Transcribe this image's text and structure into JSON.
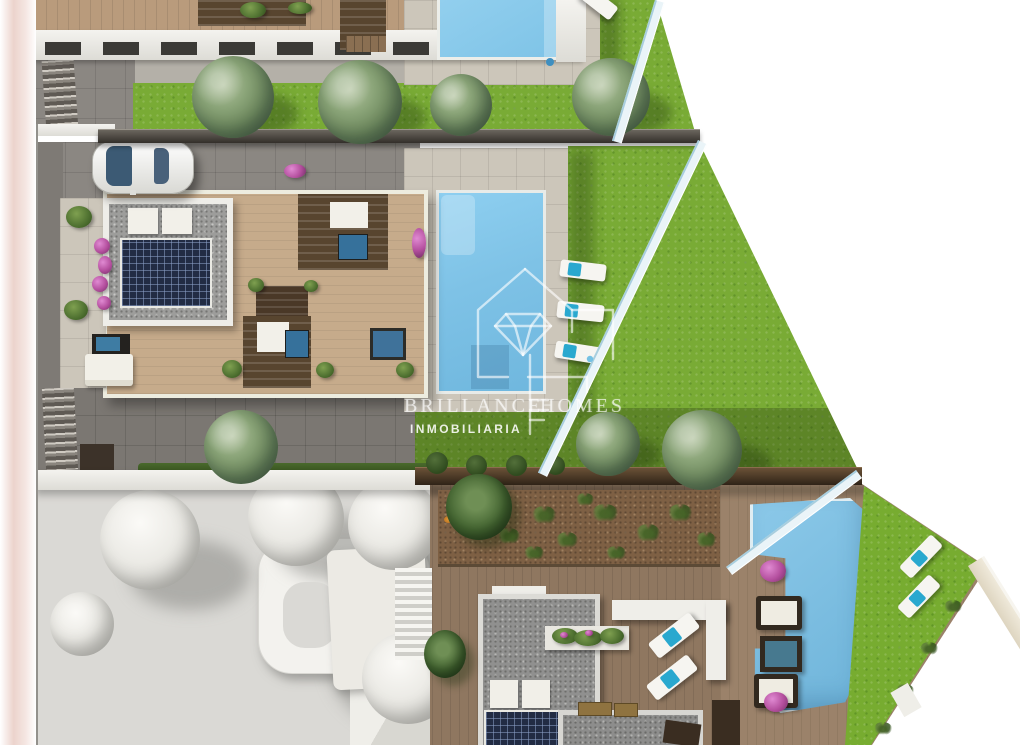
{
  "image_type": "aerial 3d architectural render of residential development",
  "watermark": {
    "brand": {
      "word1": "BRILLANCE",
      "word2": "HOMES"
    },
    "subtitle": "INMOBILIARIA",
    "logo": "house-outline-with-diamond-and-key"
  },
  "palette": {
    "grass": "#79ab35",
    "pool_water": "#7ec2e6",
    "deck_wood": "#8f7760",
    "terrace_wood": "#c6ab8b",
    "paving_light": "#ccc6ba",
    "paving_dark": "#8b8782",
    "mulch_bed": "#7e6044",
    "solar_panel": "#222c44",
    "dark_fence": "#3a3127",
    "boundary_fence": "#eaf4f8",
    "towel_cyan": "#29a8cf",
    "bougainvillea": "#b44f9e",
    "white_model": "#eceae5",
    "left_border_pink": "#ecd3cc"
  },
  "scene": {
    "pools": 3,
    "sun_loungers": 8,
    "cars": 1,
    "detailed_villas": 2,
    "white_massing_models": 1,
    "description": "Top-down site plan render: villas with roof terraces, solar panels, pergolas, pools, lawns with olive trees, and a white clay-model neighbour plot"
  }
}
